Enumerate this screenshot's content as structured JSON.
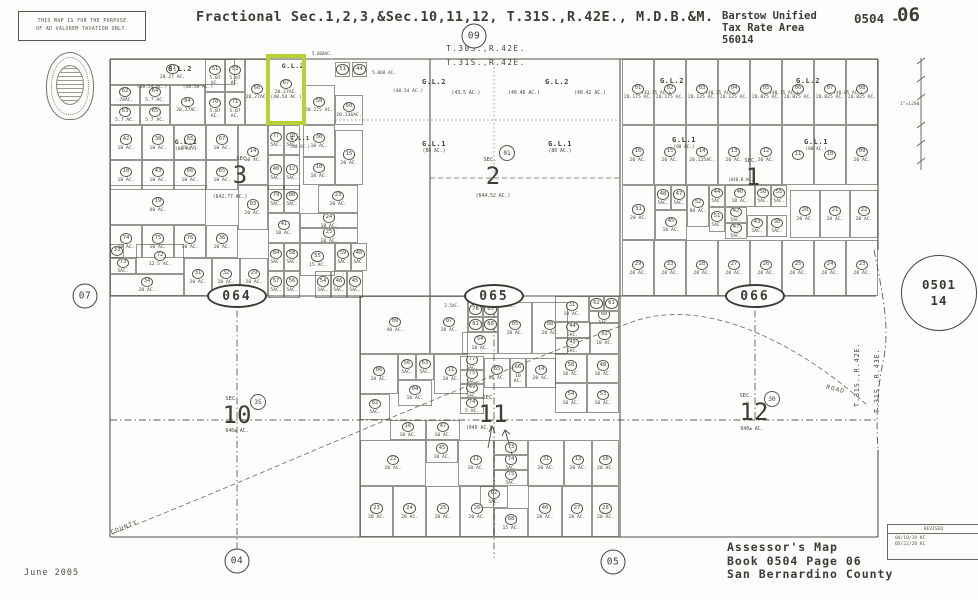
{
  "header": {
    "disclaimer_line1": "THIS MAP IS FOR THE PURPOSE",
    "disclaimer_line2": "OF AD VALOREM TAXATION ONLY.",
    "title": "Fractional Sec.1,2,3,&Sec.10,11,12, T.31S.,R.42E., M.D.B.&M.",
    "district_line1": "Barstow Unified",
    "district_line2": "Tax Rate Area",
    "district_line3": "56014",
    "sheet_prefix": "0504 -",
    "sheet_number": "06"
  },
  "township": {
    "top_north": "T.30S.,R.42E.",
    "top_south": "T.31S.,R.42E.",
    "right_west": "T.31S.,R.42E.",
    "right_east": "T.31S.,R.43E."
  },
  "scale_text": "1\"=1200'",
  "neighbor_sheet": {
    "book": "0501",
    "page": "14"
  },
  "revised": {
    "label": "REVISED",
    "entry1": "04/18/19 KC",
    "entry2": "05/22/20 KC"
  },
  "road_labels": {
    "county": "COUNTY",
    "road": "ROAD"
  },
  "footer": {
    "date": "June 2005",
    "line1": "Assessor's Map",
    "line2": "Book 0504 Page 06",
    "line3": "San Bernardino County"
  },
  "highlight_color": "#b6d235",
  "road_markers": [
    {
      "label": "09",
      "kind": "circle",
      "x": 474,
      "y": 36
    },
    {
      "label": "07",
      "kind": "circle",
      "x": 85,
      "y": 296
    },
    {
      "label": "04",
      "kind": "circle",
      "x": 237,
      "y": 561
    },
    {
      "label": "05",
      "kind": "circle",
      "x": 613,
      "y": 562
    },
    {
      "label": "064",
      "kind": "oval",
      "x": 237,
      "y": 296
    },
    {
      "label": "065",
      "kind": "oval",
      "x": 494,
      "y": 296
    },
    {
      "label": "066",
      "kind": "oval",
      "x": 755,
      "y": 296
    },
    {
      "label": "35",
      "kind": "dot",
      "x": 258,
      "y": 402
    },
    {
      "label": "30",
      "kind": "dot",
      "x": 772,
      "y": 399
    },
    {
      "label": "01",
      "kind": "dot",
      "x": 507,
      "y": 153
    }
  ],
  "notes": [
    {
      "t": "G.L.2",
      "x": 180,
      "y": 66,
      "s": 7,
      "b": 1
    },
    {
      "t": "(40.54 AC.)",
      "x": 152,
      "y": 86,
      "s": 4.6
    },
    {
      "t": "(40.58 AC.)",
      "x": 198,
      "y": 86,
      "s": 4.6
    },
    {
      "t": "G.L.2",
      "x": 293,
      "y": 63,
      "s": 6.5,
      "b": 1
    },
    {
      "t": "5.068AC.",
      "x": 322,
      "y": 52,
      "s": 4.2
    },
    {
      "t": "5.068 AC.",
      "x": 384,
      "y": 72,
      "s": 4.4
    },
    {
      "t": "(40.54 AC.)",
      "x": 408,
      "y": 90,
      "s": 4.6
    },
    {
      "t": "G.L.2",
      "x": 434,
      "y": 79,
      "s": 7,
      "b": 1
    },
    {
      "t": "(43.5 AC.)",
      "x": 466,
      "y": 92,
      "s": 4.8
    },
    {
      "t": "G.L.2",
      "x": 557,
      "y": 79,
      "s": 7,
      "b": 1
    },
    {
      "t": "(40.46 AC.)",
      "x": 524,
      "y": 92,
      "s": 4.8
    },
    {
      "t": "(40.42 AC.)",
      "x": 590,
      "y": 92,
      "s": 4.8
    },
    {
      "t": "G.L.1",
      "x": 434,
      "y": 141,
      "s": 7,
      "b": 1
    },
    {
      "t": "(80 AC.)",
      "x": 434,
      "y": 150,
      "s": 4.8
    },
    {
      "t": "G.L.1",
      "x": 560,
      "y": 141,
      "s": 7,
      "b": 1
    },
    {
      "t": "(80 AC.)",
      "x": 560,
      "y": 150,
      "s": 4.8
    },
    {
      "t": "G.L.1",
      "x": 186,
      "y": 139,
      "s": 6.5,
      "b": 1
    },
    {
      "t": "(80 AC.)",
      "x": 186,
      "y": 148,
      "s": 4.6
    },
    {
      "t": "G.L.1",
      "x": 300,
      "y": 137,
      "s": 5.5,
      "b": 1
    },
    {
      "t": "(80 AC.)",
      "x": 300,
      "y": 145,
      "s": 4.2
    },
    {
      "t": "G.L.2",
      "x": 672,
      "y": 78,
      "s": 7,
      "b": 1
    },
    {
      "t": "G.L.2",
      "x": 808,
      "y": 78,
      "s": 7,
      "b": 1
    },
    {
      "t": "(43.35 AC.)",
      "x": 656,
      "y": 92,
      "s": 4.4
    },
    {
      "t": "(40.25 AC.)",
      "x": 720,
      "y": 92,
      "s": 4.4
    },
    {
      "t": "(40.15 AC.)",
      "x": 784,
      "y": 92,
      "s": 4.4
    },
    {
      "t": "(40.05 AC.)",
      "x": 848,
      "y": 92,
      "s": 4.4
    },
    {
      "t": "G.L.1",
      "x": 684,
      "y": 137,
      "s": 7,
      "b": 1
    },
    {
      "t": "(80 AC.)",
      "x": 684,
      "y": 146,
      "s": 4.4
    },
    {
      "t": "G.L.1",
      "x": 816,
      "y": 139,
      "s": 7,
      "b": 1
    },
    {
      "t": "(80 AC.)",
      "x": 816,
      "y": 148,
      "s": 4.4
    },
    {
      "t": "(642.77 AC.)",
      "x": 230,
      "y": 196,
      "s": 4.8
    },
    {
      "t": "(640.8 AC.)",
      "x": 742,
      "y": 178,
      "s": 4.2
    },
    {
      "t": "2.5AC.",
      "x": 452,
      "y": 304,
      "s": 4.2
    },
    {
      "t": "2.5AC.",
      "x": 508,
      "y": 304,
      "s": 4.2
    },
    {
      "t": "SEC.",
      "x": 243,
      "y": 157,
      "s": 5.5
    },
    {
      "t": "3",
      "x": 240,
      "y": 163,
      "s": 24,
      "n": 1
    },
    {
      "t": "SEC.",
      "x": 490,
      "y": 158,
      "s": 5.5
    },
    {
      "t": "2",
      "x": 493,
      "y": 164,
      "s": 24,
      "n": 1
    },
    {
      "t": "(644.52 AC.)",
      "x": 493,
      "y": 195,
      "s": 4.8
    },
    {
      "t": "SEC.",
      "x": 751,
      "y": 159,
      "s": 5.5
    },
    {
      "t": "1",
      "x": 753,
      "y": 165,
      "s": 24,
      "n": 1
    },
    {
      "t": "SEC.",
      "x": 232,
      "y": 397,
      "s": 5.5
    },
    {
      "t": "10",
      "x": 237,
      "y": 403,
      "s": 24,
      "n": 1
    },
    {
      "t": "640± AC.",
      "x": 237,
      "y": 430,
      "s": 4.8
    },
    {
      "t": "SEC.",
      "x": 489,
      "y": 396,
      "s": 5.5
    },
    {
      "t": "11",
      "x": 493,
      "y": 402,
      "s": 24,
      "n": 1
    },
    {
      "t": "(640 AC.)",
      "x": 479,
      "y": 427,
      "s": 4.8
    },
    {
      "t": "SEC.",
      "x": 746,
      "y": 394,
      "s": 5.5
    },
    {
      "t": "12",
      "x": 754,
      "y": 400,
      "s": 24,
      "n": 1
    },
    {
      "t": "640± AC.",
      "x": 752,
      "y": 428,
      "s": 4.8
    }
  ],
  "parcels": [
    [
      110,
      59,
      125,
      26,
      "61",
      "20.27 AC."
    ],
    [
      110,
      85,
      30,
      20,
      "62",
      ".78AC."
    ],
    [
      140,
      85,
      30,
      20,
      "64",
      "5.7 AC."
    ],
    [
      110,
      105,
      30,
      20,
      "63",
      "5.7 AC."
    ],
    [
      140,
      105,
      30,
      20,
      "65",
      "5.7 AC."
    ],
    [
      170,
      85,
      35,
      40,
      "84",
      "20.27AC."
    ],
    [
      205,
      59,
      20,
      33,
      "51",
      "5.07 AC."
    ],
    [
      225,
      59,
      20,
      33,
      "53",
      "5.07 AC."
    ],
    [
      205,
      92,
      20,
      33,
      "70",
      "5.07 AC."
    ],
    [
      225,
      92,
      20,
      33,
      "71",
      "5.07 AC."
    ],
    [
      245,
      59,
      24,
      66,
      "66",
      "20.27AC."
    ],
    [
      269,
      57,
      34,
      65,
      "67",
      "20.27AC. (40.54 AC.)",
      1
    ],
    [
      303,
      85,
      32,
      40,
      "58",
      "20.275 AC."
    ],
    [
      335,
      62,
      15,
      15,
      "51",
      ""
    ],
    [
      352,
      62,
      15,
      15,
      "44",
      ""
    ],
    [
      335,
      95,
      28,
      30,
      "60",
      "20.136AC."
    ],
    [
      335,
      130,
      28,
      55,
      "15",
      "20 AC."
    ],
    [
      110,
      125,
      32,
      35,
      "42",
      "10 AC."
    ],
    [
      142,
      125,
      32,
      35,
      "38",
      "10 AC."
    ],
    [
      174,
      125,
      32,
      35,
      "65",
      "10 AC."
    ],
    [
      206,
      125,
      32,
      35,
      "67",
      "10 AC."
    ],
    [
      238,
      125,
      30,
      60,
      "14",
      "20 AC."
    ],
    [
      110,
      160,
      32,
      30,
      "18",
      "10 AC."
    ],
    [
      142,
      160,
      32,
      30,
      "43",
      "10 AC."
    ],
    [
      174,
      160,
      32,
      30,
      "66",
      "10 AC."
    ],
    [
      206,
      160,
      32,
      30,
      "65",
      "10 AC."
    ],
    [
      268,
      125,
      16,
      30,
      "77",
      "5AC."
    ],
    [
      284,
      125,
      16,
      30,
      "78",
      "5AC."
    ],
    [
      268,
      155,
      16,
      35,
      "40",
      "5AC."
    ],
    [
      284,
      155,
      16,
      35,
      "12",
      "5AC."
    ],
    [
      303,
      125,
      32,
      32,
      "30",
      "10 AC."
    ],
    [
      303,
      157,
      32,
      28,
      "10",
      "10 AC."
    ],
    [
      110,
      185,
      96,
      40,
      "19",
      "40 AC."
    ],
    [
      238,
      185,
      30,
      45,
      "83",
      "20 AC."
    ],
    [
      268,
      185,
      16,
      28,
      "79",
      "5AC."
    ],
    [
      284,
      185,
      16,
      28,
      "80",
      "5AC."
    ],
    [
      318,
      185,
      40,
      28,
      "23",
      "20 AC."
    ],
    [
      268,
      213,
      32,
      30,
      "41",
      "10 AC."
    ],
    [
      300,
      213,
      58,
      15,
      "24",
      "10 AC."
    ],
    [
      300,
      228,
      58,
      15,
      "25",
      "10 AC."
    ],
    [
      110,
      225,
      32,
      33,
      "74",
      "10 AC."
    ],
    [
      142,
      225,
      32,
      33,
      "75",
      "10 AC."
    ],
    [
      174,
      225,
      32,
      33,
      "76",
      "10 AC."
    ],
    [
      206,
      225,
      32,
      33,
      "36",
      "10 AC."
    ],
    [
      268,
      243,
      16,
      28,
      "84",
      "5AC."
    ],
    [
      284,
      243,
      16,
      28,
      "58",
      "5AC."
    ],
    [
      300,
      243,
      35,
      33,
      "55",
      "15 AC."
    ],
    [
      335,
      243,
      16,
      28,
      "59",
      "5AC."
    ],
    [
      351,
      243,
      16,
      28,
      "48",
      "5AC."
    ],
    [
      268,
      271,
      16,
      27,
      "57",
      "5AC."
    ],
    [
      284,
      271,
      16,
      27,
      "56",
      "5AC."
    ],
    [
      315,
      271,
      16,
      27,
      "54",
      "5AC."
    ],
    [
      331,
      271,
      16,
      27,
      "46",
      "5AC."
    ],
    [
      347,
      271,
      16,
      27,
      "45",
      "5AC."
    ],
    [
      110,
      244,
      14,
      14,
      "33",
      ""
    ],
    [
      110,
      258,
      26,
      16,
      "73",
      "5AC."
    ],
    [
      136,
      244,
      48,
      30,
      "72",
      "12.5 AC."
    ],
    [
      110,
      274,
      74,
      22,
      "34",
      "20 AC."
    ],
    [
      184,
      258,
      28,
      38,
      "31",
      "20 AC."
    ],
    [
      212,
      258,
      28,
      38,
      "32",
      "20 AC."
    ],
    [
      240,
      258,
      28,
      38,
      "29",
      "20 AC."
    ],
    [
      622,
      59,
      32,
      66,
      "01",
      "20.175 AC."
    ],
    [
      654,
      59,
      32,
      66,
      "02",
      "20.175 AC."
    ],
    [
      686,
      59,
      32,
      66,
      "03",
      "20.125 AC."
    ],
    [
      718,
      59,
      32,
      66,
      "04",
      "20.125 AC."
    ],
    [
      750,
      59,
      32,
      66,
      "05",
      "20.075 AC."
    ],
    [
      782,
      59,
      32,
      66,
      "06",
      "20.075 AC."
    ],
    [
      814,
      59,
      32,
      66,
      "07",
      "20.025 AC."
    ],
    [
      846,
      59,
      32,
      66,
      "08",
      "20.025 AC."
    ],
    [
      622,
      125,
      32,
      60,
      "16",
      "20 AC."
    ],
    [
      654,
      125,
      32,
      60,
      "15",
      "20 AC."
    ],
    [
      686,
      125,
      32,
      60,
      "14",
      "20.125AC."
    ],
    [
      718,
      125,
      32,
      60,
      "13",
      "20 AC."
    ],
    [
      750,
      125,
      32,
      60,
      "12",
      "20 AC."
    ],
    [
      782,
      125,
      32,
      60,
      "11",
      ""
    ],
    [
      814,
      125,
      32,
      60,
      "10",
      ""
    ],
    [
      846,
      125,
      32,
      60,
      "09",
      "20 AC."
    ],
    [
      622,
      185,
      33,
      55,
      "31",
      "20 AC."
    ],
    [
      655,
      185,
      16,
      25,
      "48",
      "5AC."
    ],
    [
      671,
      185,
      16,
      25,
      "47",
      "5AC."
    ],
    [
      687,
      185,
      22,
      42,
      "52",
      "80 AC."
    ],
    [
      709,
      185,
      16,
      22,
      "44",
      "5AC."
    ],
    [
      725,
      185,
      30,
      22,
      "40",
      "10 AC."
    ],
    [
      755,
      185,
      16,
      22,
      "50",
      "5AC."
    ],
    [
      771,
      185,
      16,
      22,
      "55",
      "5AC."
    ],
    [
      655,
      210,
      32,
      30,
      "45",
      "10 AC."
    ],
    [
      709,
      207,
      16,
      25,
      "51",
      "5AC."
    ],
    [
      725,
      207,
      22,
      16,
      "42",
      "5AC."
    ],
    [
      725,
      223,
      22,
      16,
      "47",
      "5AC."
    ],
    [
      747,
      215,
      20,
      22,
      "43",
      "5AC."
    ],
    [
      767,
      215,
      20,
      22,
      "38",
      "5AC."
    ],
    [
      790,
      190,
      30,
      48,
      "20",
      "20 AC."
    ],
    [
      820,
      190,
      30,
      48,
      "21",
      "20 AC."
    ],
    [
      850,
      190,
      28,
      48,
      "22",
      "20 AC."
    ],
    [
      622,
      240,
      32,
      56,
      "29",
      "20 AC."
    ],
    [
      654,
      240,
      32,
      56,
      "33",
      "20 AC."
    ],
    [
      686,
      240,
      32,
      56,
      "28",
      "20 AC."
    ],
    [
      718,
      240,
      32,
      56,
      "27",
      "20 AC."
    ],
    [
      750,
      240,
      32,
      56,
      "26",
      "20 AC."
    ],
    [
      782,
      240,
      32,
      56,
      "25",
      "20 AC."
    ],
    [
      814,
      240,
      32,
      56,
      "24",
      "20 AC."
    ],
    [
      846,
      240,
      32,
      56,
      "23",
      "20 AC."
    ],
    [
      360,
      296,
      70,
      58,
      "09",
      "40 AC."
    ],
    [
      430,
      296,
      38,
      58,
      "07",
      "20 AC."
    ],
    [
      468,
      302,
      15,
      15,
      "78",
      ""
    ],
    [
      483,
      302,
      15,
      15,
      "85",
      ""
    ],
    [
      468,
      317,
      15,
      15,
      "81",
      ""
    ],
    [
      483,
      317,
      15,
      15,
      "80",
      ""
    ],
    [
      498,
      302,
      34,
      52,
      "05",
      "20 AC."
    ],
    [
      532,
      302,
      36,
      52,
      "08",
      "20 AC."
    ],
    [
      462,
      332,
      36,
      22,
      "54",
      "10 AC."
    ],
    [
      555,
      296,
      34,
      26,
      "31",
      "10 AC."
    ],
    [
      589,
      296,
      15,
      15,
      "62",
      ""
    ],
    [
      604,
      296,
      15,
      15,
      "61",
      ""
    ],
    [
      589,
      311,
      30,
      13,
      "60",
      "5AC."
    ],
    [
      555,
      322,
      35,
      16,
      "44",
      "5AC."
    ],
    [
      555,
      338,
      35,
      16,
      "45",
      "5AC."
    ],
    [
      590,
      322,
      29,
      32,
      "52",
      "10 AC."
    ],
    [
      555,
      354,
      32,
      29,
      "58",
      "10 AC."
    ],
    [
      587,
      354,
      32,
      29,
      "48",
      "10 AC."
    ],
    [
      555,
      383,
      32,
      30,
      "54",
      "10 AC."
    ],
    [
      587,
      383,
      32,
      30,
      "53",
      "10 AC."
    ],
    [
      360,
      354,
      38,
      40,
      "06",
      "20 AC."
    ],
    [
      398,
      354,
      18,
      26,
      "56",
      "5AC."
    ],
    [
      416,
      354,
      18,
      26,
      "63",
      "5AC."
    ],
    [
      434,
      354,
      34,
      40,
      "11",
      "20 AC."
    ],
    [
      460,
      356,
      24,
      14,
      "77",
      "5AC."
    ],
    [
      460,
      370,
      24,
      14,
      "75",
      "5AC."
    ],
    [
      460,
      384,
      24,
      14,
      "49",
      "5AC."
    ],
    [
      460,
      398,
      24,
      16,
      "74",
      "5 AC."
    ],
    [
      484,
      358,
      26,
      30,
      "65",
      "10 AC."
    ],
    [
      510,
      358,
      16,
      30,
      "66",
      "10 AC."
    ],
    [
      526,
      358,
      30,
      30,
      "14",
      "20 AC."
    ],
    [
      398,
      380,
      34,
      26,
      "04",
      "10 AC."
    ],
    [
      360,
      394,
      30,
      26,
      "82",
      "5AC."
    ],
    [
      390,
      420,
      36,
      20,
      "16",
      "10 AC."
    ],
    [
      426,
      420,
      34,
      20,
      "47",
      "10 AC."
    ],
    [
      360,
      440,
      66,
      46,
      "22",
      "20 AC."
    ],
    [
      426,
      440,
      32,
      23,
      "45",
      "10 AC."
    ],
    [
      458,
      440,
      36,
      46,
      "11",
      "20 AC."
    ],
    [
      494,
      440,
      34,
      15,
      "73",
      ""
    ],
    [
      494,
      455,
      34,
      15,
      "74",
      "5AC."
    ],
    [
      494,
      470,
      34,
      16,
      "75",
      "5AC."
    ],
    [
      528,
      440,
      36,
      46,
      "31",
      "20 AC."
    ],
    [
      564,
      440,
      28,
      46,
      "13",
      "20 AC."
    ],
    [
      592,
      440,
      27,
      46,
      "16",
      "20 AC."
    ],
    [
      480,
      486,
      28,
      22,
      "62",
      "5AC."
    ],
    [
      360,
      486,
      33,
      51,
      "23",
      "20 AC."
    ],
    [
      393,
      486,
      33,
      51,
      "24",
      "20 AC."
    ],
    [
      426,
      486,
      34,
      51,
      "25",
      "20 AC."
    ],
    [
      460,
      486,
      34,
      51,
      "26",
      "20 AC."
    ],
    [
      494,
      508,
      34,
      29,
      "68",
      "15 AC."
    ],
    [
      528,
      486,
      34,
      51,
      "40",
      "20 AC."
    ],
    [
      562,
      486,
      30,
      51,
      "27",
      "20 AC."
    ],
    [
      592,
      486,
      27,
      51,
      "28",
      "20 AC."
    ]
  ]
}
